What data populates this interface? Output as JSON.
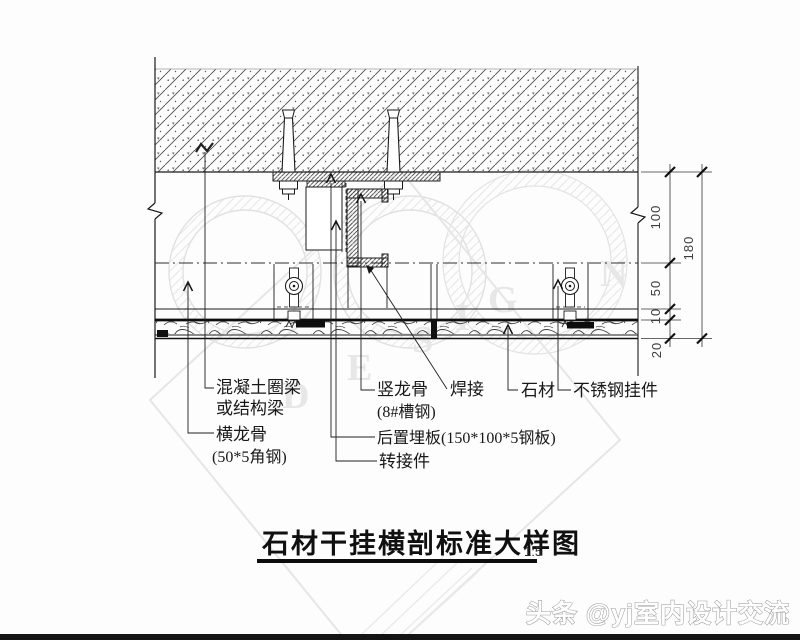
{
  "title": {
    "text": "石材干挂横剖标准大样图",
    "scale": "1:5"
  },
  "callouts": {
    "concrete_beam": [
      "混凝土圈梁",
      "或结构梁"
    ],
    "horizontal_keel": [
      "横龙骨",
      "(50*5角钢)"
    ],
    "vertical_keel": [
      "竖龙骨",
      "(8#槽钢)"
    ],
    "weld": "焊接",
    "stone": "石材",
    "stainless_hanger": "不锈钢挂件",
    "embed_plate": "后置埋板(150*100*5钢板)",
    "adapter": "转接件"
  },
  "dimensions": {
    "seg_100": "100",
    "seg_50": "50",
    "seg_10": "10",
    "seg_20": "20",
    "total": "180"
  },
  "watermark": {
    "footer": "头条 @yj室内设计交流",
    "letters": [
      "D",
      "E",
      "S",
      "I",
      "G",
      "N"
    ]
  },
  "colors": {
    "ink": "#1a1a1a",
    "watermark_gray": "#e2e2e2",
    "bottom_bar": "#141414"
  }
}
